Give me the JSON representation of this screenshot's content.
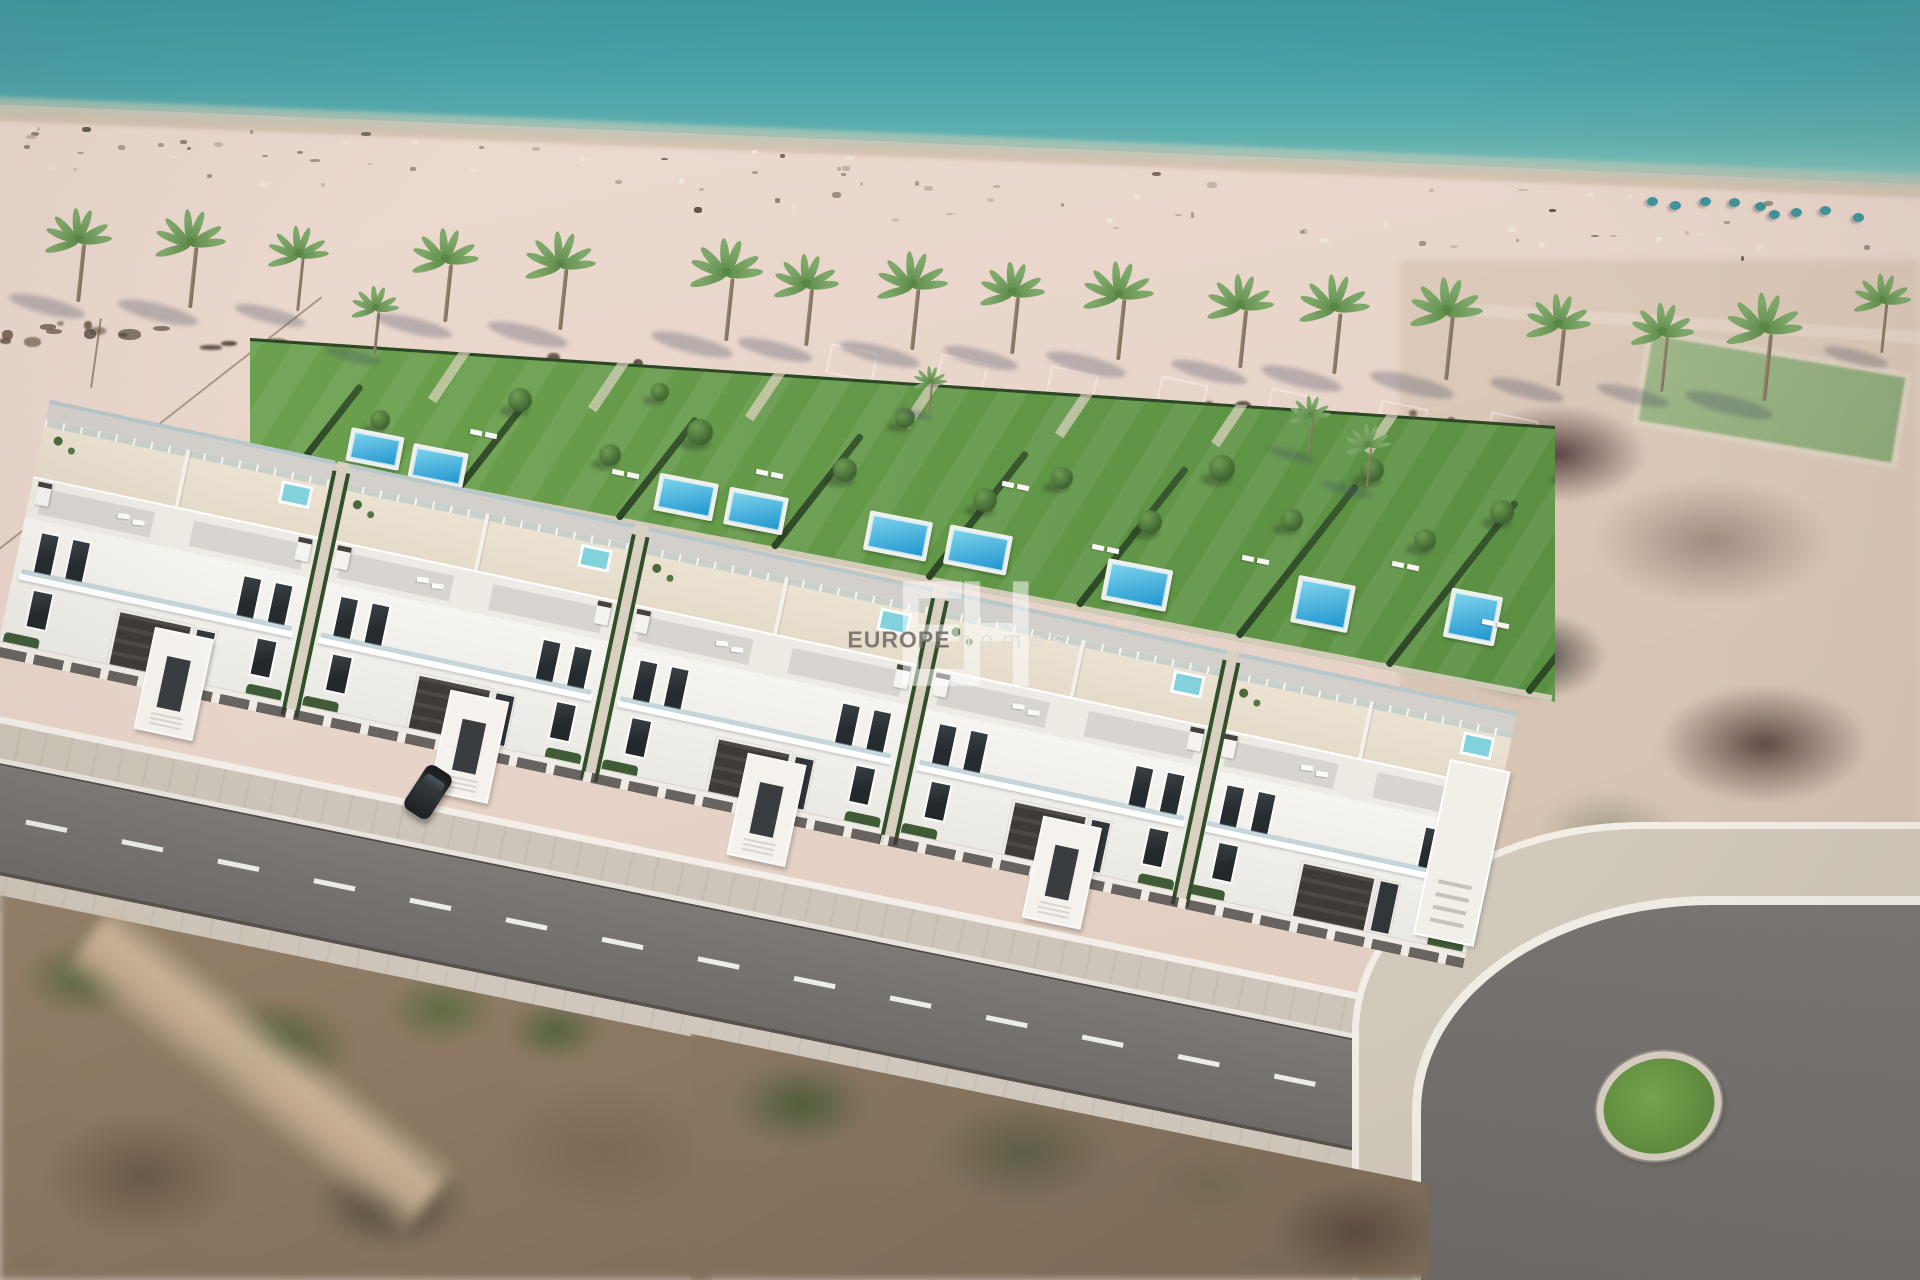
{
  "meta": {
    "kind": "aerial-3d-architectural-render",
    "subject": "beachfront villa development with private pools beside a sandy beach and sea"
  },
  "watermark": {
    "monogram": "EH",
    "brand": "EUROPE",
    "suffix": "homes"
  },
  "palette": {
    "sea_deep": "#3e98a1",
    "sea_shore": "#86c2b9",
    "wet_sand": "#cdb9a9",
    "sand": "#e7d3c8",
    "debris_dark": "#4e4238",
    "debris_brown": "#6b5647",
    "palm_leaf": "#7ea86a",
    "palm_leaf_dark": "#5d8a49",
    "palm_trunk": "#8d7c66",
    "shadow_blue": "rgba(70,76,98,0.30)",
    "lawn": "#68a04c",
    "hedge": "#2f4c27",
    "pool_light": "#7fd4ec",
    "pool_deep": "#1f95cf",
    "pool_deck": "#eef0ec",
    "villa_white": "#f5f3ef",
    "roof_gray": "#d3d0cb",
    "terrace_cream": "#ebe2d2",
    "glass": "rgba(160,192,203,0.55)",
    "anthracite": "#3e3a36",
    "asphalt": "#757170",
    "sidewalk": "#cdc5b9",
    "curb_white": "#f2eee6",
    "roundabout_green": "#6b9c45"
  },
  "scene": {
    "sea": {
      "waterline_left_y": 105,
      "waterline_right_y": 182
    },
    "palms": [
      [
        78,
        300,
        1.0
      ],
      [
        190,
        306,
        1.05
      ],
      [
        298,
        310,
        0.92
      ],
      [
        375,
        352,
        0.72
      ],
      [
        445,
        320,
        1.0
      ],
      [
        560,
        328,
        1.05
      ],
      [
        726,
        338,
        1.08
      ],
      [
        806,
        344,
        0.98
      ],
      [
        912,
        348,
        1.05
      ],
      [
        1012,
        352,
        0.98
      ],
      [
        1118,
        358,
        1.05
      ],
      [
        1240,
        366,
        1.0
      ],
      [
        1334,
        372,
        1.06
      ],
      [
        1446,
        378,
        1.1
      ],
      [
        1558,
        384,
        0.98
      ],
      [
        1662,
        390,
        0.95
      ],
      [
        1764,
        398,
        1.15
      ],
      [
        1882,
        352,
        0.85
      ],
      [
        1310,
        452,
        0.62
      ],
      [
        1368,
        486,
        0.68
      ],
      [
        930,
        412,
        0.5
      ]
    ],
    "beach": {
      "speck_count": 85,
      "parasol_clusters": [
        [
          1640,
          196,
          5
        ],
        [
          1762,
          206,
          4
        ]
      ],
      "plot_squares": [
        [
          828,
          348
        ],
        [
          938,
          358
        ],
        [
          1048,
          370
        ],
        [
          1158,
          380
        ],
        [
          1268,
          392
        ],
        [
          1378,
          404
        ],
        [
          1488,
          416
        ]
      ]
    },
    "debris": {
      "count": 62
    },
    "gardens": {
      "hedge_x": [
        300,
        455,
        615,
        770,
        925,
        1075,
        1235,
        1385,
        1525
      ],
      "walkways": [
        445,
        605,
        762,
        918,
        1072,
        1228,
        1380
      ],
      "pools": [
        [
          352,
          436,
          46,
          26
        ],
        [
          414,
          452,
          48,
          28
        ],
        [
          660,
          482,
          52,
          30
        ],
        [
          730,
          496,
          52,
          30
        ],
        [
          870,
          520,
          56,
          32
        ],
        [
          950,
          534,
          56,
          32
        ],
        [
          1108,
          568,
          58,
          34
        ],
        [
          1298,
          584,
          50,
          40
        ],
        [
          1451,
          596,
          44,
          42
        ]
      ],
      "trees": [
        [
          380,
          420,
          10
        ],
        [
          520,
          400,
          12
        ],
        [
          610,
          455,
          11
        ],
        [
          700,
          432,
          13
        ],
        [
          762,
          518,
          10
        ],
        [
          845,
          470,
          12
        ],
        [
          905,
          418,
          10
        ],
        [
          985,
          500,
          12
        ],
        [
          1062,
          478,
          11
        ],
        [
          1150,
          522,
          12
        ],
        [
          1222,
          468,
          13
        ],
        [
          1292,
          520,
          11
        ],
        [
          1372,
          470,
          12
        ],
        [
          1425,
          540,
          11
        ],
        [
          1502,
          512,
          12
        ],
        [
          660,
          392,
          9
        ],
        [
          1570,
          470,
          11
        ],
        [
          1620,
          520,
          10
        ]
      ],
      "sunbeds": [
        [
          470,
          430
        ],
        [
          612,
          470
        ],
        [
          756,
          470
        ],
        [
          1002,
          482
        ],
        [
          1092,
          545
        ],
        [
          1242,
          556
        ],
        [
          1392,
          562
        ],
        [
          1482,
          620
        ]
      ]
    },
    "estate": {
      "clusters": [
        {
          "x": 0,
          "w": 292,
          "tower": false
        },
        {
          "x": 306,
          "w": 292,
          "tower": false
        },
        {
          "x": 612,
          "w": 292,
          "tower": false
        },
        {
          "x": 918,
          "w": 286,
          "tower": false
        },
        {
          "x": 1212,
          "w": 288,
          "tower": true
        }
      ],
      "gaps": [
        294,
        600,
        906,
        1204
      ],
      "porticos": [
        150,
        452,
        756,
        1058
      ]
    },
    "road": {
      "dash_len": 42,
      "dash_gap": 56
    },
    "roundabout": {
      "cx": 1652,
      "cy": 1099
    },
    "car": {
      "present": true
    }
  }
}
